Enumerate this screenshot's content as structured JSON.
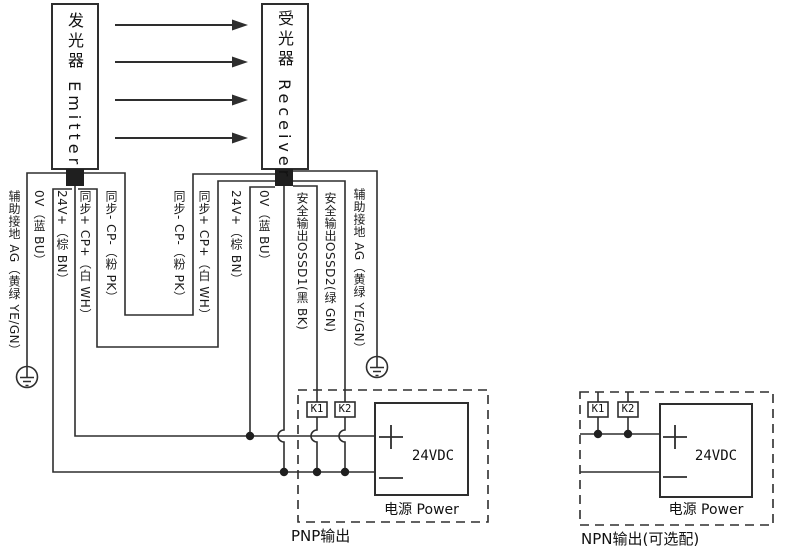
{
  "devices": {
    "emitter": {
      "label": "发光器 Emitter"
    },
    "receiver": {
      "label": "受光器 Receiver"
    }
  },
  "emitter_wires": [
    {
      "label": "辅助接地 AG（黄绿 YE/GN）"
    },
    {
      "label": "0V（蓝 BU）"
    },
    {
      "label": "24V+（棕 BN）"
    },
    {
      "label": "同步+ CP+（白 WH）"
    },
    {
      "label": "同步- CP-（粉 PK）"
    }
  ],
  "receiver_wires": [
    {
      "label": "同步- CP-（粉 PK）"
    },
    {
      "label": "同步+ CP+（白 WH）"
    },
    {
      "label": "24V+（棕 BN）"
    },
    {
      "label": "0V（蓝 BU）"
    },
    {
      "label": "安全输出OSSD1(黑 BK)"
    },
    {
      "label": "安全输出OSSD2(绿 GN)"
    },
    {
      "label": "辅助接地 AG（黄绿 YE/GN）"
    }
  ],
  "pnp_circuit": {
    "caption": "PNP输出",
    "relay1": "K1",
    "relay2": "K2",
    "power": {
      "voltage": "24VDC",
      "name": "电源 Power",
      "plus": "+",
      "minus": "−"
    }
  },
  "npn_circuit": {
    "caption": "NPN输出(可选配)",
    "relay1": "K1",
    "relay2": "K2",
    "power": {
      "voltage": "24VDC",
      "name": "电源 Power",
      "plus": "+",
      "minus": "−"
    }
  },
  "colors": {
    "line": "#2e2e2e",
    "text": "#1c1c1c",
    "background": "#ffffff"
  }
}
